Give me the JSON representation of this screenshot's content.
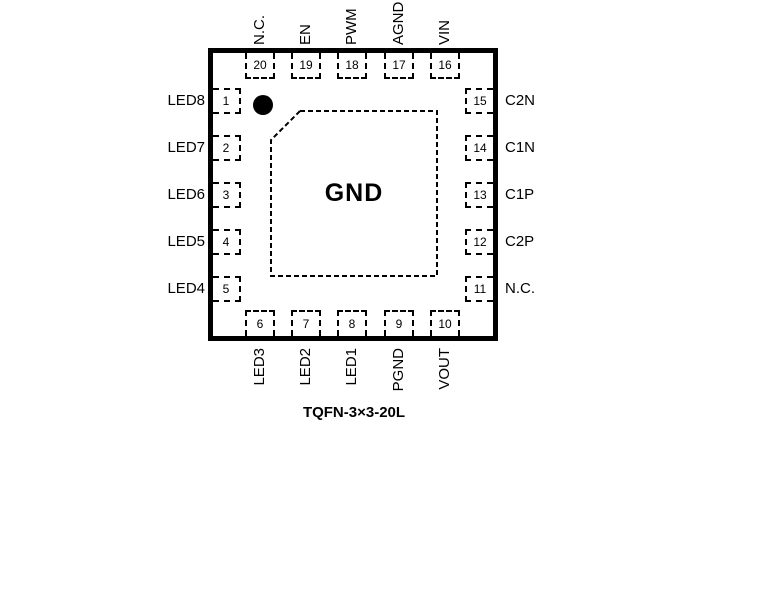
{
  "diagram": {
    "package_name": "TQFN-3×3-20L",
    "center_pad_label": "GND"
  },
  "colors": {
    "line": "#000000",
    "background": "#ffffff"
  },
  "icons": {
    "pin1_marker": "filled-circle"
  },
  "pins": {
    "top": [
      {
        "number": "20",
        "name": "N.C."
      },
      {
        "number": "19",
        "name": "EN"
      },
      {
        "number": "18",
        "name": "PWM"
      },
      {
        "number": "17",
        "name": "AGND"
      },
      {
        "number": "16",
        "name": "VIN"
      }
    ],
    "left": [
      {
        "number": "1",
        "name": "LED8"
      },
      {
        "number": "2",
        "name": "LED7"
      },
      {
        "number": "3",
        "name": "LED6"
      },
      {
        "number": "4",
        "name": "LED5"
      },
      {
        "number": "5",
        "name": "LED4"
      }
    ],
    "right": [
      {
        "number": "15",
        "name": "C2N"
      },
      {
        "number": "14",
        "name": "C1N"
      },
      {
        "number": "13",
        "name": "C1P"
      },
      {
        "number": "12",
        "name": "C2P"
      },
      {
        "number": "11",
        "name": "N.C."
      }
    ],
    "bottom": [
      {
        "number": "6",
        "name": "LED3"
      },
      {
        "number": "7",
        "name": "LED2"
      },
      {
        "number": "8",
        "name": "LED1"
      },
      {
        "number": "9",
        "name": "PGND"
      },
      {
        "number": "10",
        "name": "VOUT"
      }
    ]
  }
}
